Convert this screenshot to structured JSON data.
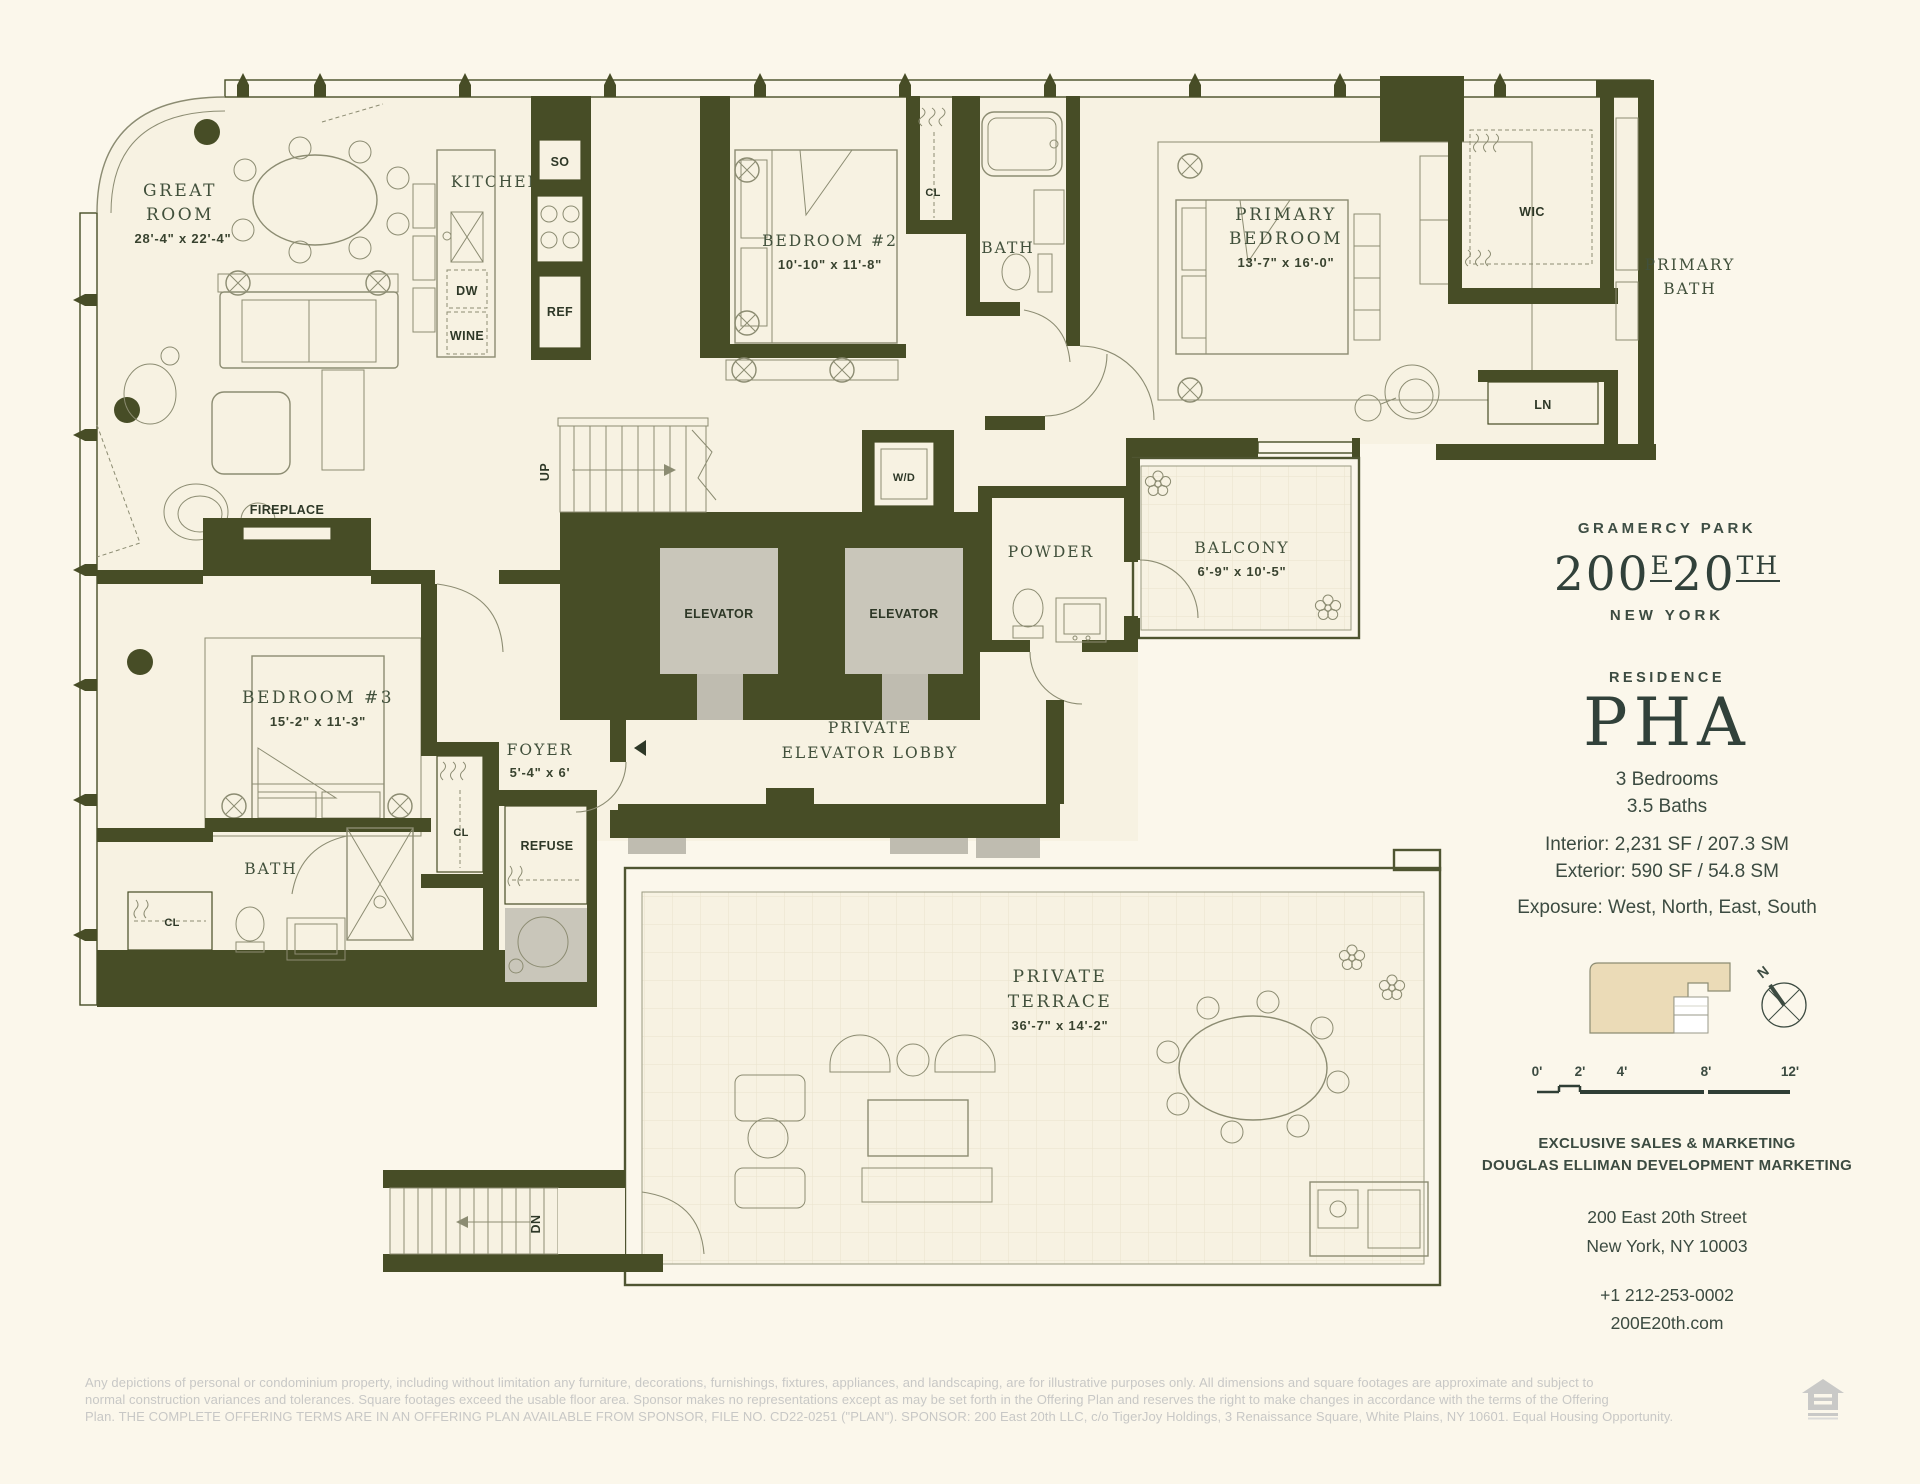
{
  "colors": {
    "wall": "#474D26",
    "room_fill": "#F7F2E2",
    "brand_green": "#3C4B41",
    "keyplan_beige": "#EBDBB7",
    "elevator_gray": "#C9C6BA"
  },
  "plan": {
    "great_room": {
      "l1": "GREAT",
      "l2": "ROOM",
      "dims": "28'-4\" x 22'-4\""
    },
    "kitchen": "KITCHEN",
    "so": "SO",
    "ref": "REF",
    "dw": "DW",
    "wine": "WINE",
    "bedroom2": {
      "label": "BEDROOM #2",
      "dims": "10'-10\" x 11'-8\""
    },
    "bath": "BATH",
    "cl": "CL",
    "primary_bedroom": {
      "l1": "PRIMARY",
      "l2": "BEDROOM",
      "dims": "13'-7\" x 16'-0\""
    },
    "wic": "WIC",
    "primary_bath": {
      "l1": "PRIMARY",
      "l2": "BATH"
    },
    "ln": "LN",
    "wd": "W/D",
    "elevator": "ELEVATOR",
    "up": "UP",
    "dn": "DN",
    "fireplace": "FIREPLACE",
    "powder": "POWDER",
    "balcony": {
      "label": "BALCONY",
      "dims": "6'-9\" x 10'-5\""
    },
    "bedroom3": {
      "label": "BEDROOM #3",
      "dims": "15'-2\" x 11'-3\""
    },
    "foyer": {
      "label": "FOYER",
      "dims": "5'-4\" x 6'"
    },
    "lobby": {
      "l1": "PRIVATE",
      "l2": "ELEVATOR LOBBY"
    },
    "refuse": "REFUSE",
    "terrace": {
      "l1": "PRIVATE",
      "l2": "TERRACE",
      "dims": "36'-7\" x 14'-2\""
    }
  },
  "sidebar": {
    "location": "GRAMERCY PARK",
    "logo": {
      "p1": "200",
      "sup1": "E",
      "p2": "20",
      "sup2": "TH"
    },
    "city": "NEW YORK",
    "residence_label": "RESIDENCE",
    "residence_name": "PHA",
    "bedrooms": "3 Bedrooms",
    "baths": "3.5 Baths",
    "interior": "Interior: 2,231 SF / 207.3 SM",
    "exterior": "Exterior: 590 SF / 54.8 SM",
    "exposure": "Exposure: West, North, East, South",
    "compass_n": "N",
    "scale_ticks": [
      "0'",
      "2'",
      "4'",
      "8'",
      "12'"
    ],
    "marketing1": "EXCLUSIVE SALES & MARKETING",
    "marketing2": "DOUGLAS ELLIMAN DEVELOPMENT MARKETING",
    "address1": "200 East 20th Street",
    "address2": "New York, NY 10003",
    "phone": "+1 212-253-0002",
    "website": "200E20th.com"
  },
  "disclaimer": {
    "lines": [
      "Any depictions of personal or condominium property, including without limitation any furniture, decorations, furnishings, fixtures, appliances, and landscaping, are for illustrative purposes only. All dimensions and square footages are approximate and subject to",
      "normal construction variances and tolerances.  Square footages exceed the usable floor area. Sponsor makes no representations except as may be set forth in the Offering Plan and reserves the right to make changes in accordance with the terms of the Offering",
      "Plan. THE COMPLETE OFFERING TERMS ARE IN AN OFFERING PLAN AVAILABLE FROM SPONSOR, FILE NO. CD22-0251 (\"PLAN\"). SPONSOR: 200 East 20th LLC, c/o TigerJoy Holdings, 3 Renaissance Square, White Plains, NY 10601. Equal Housing Opportunity."
    ]
  }
}
